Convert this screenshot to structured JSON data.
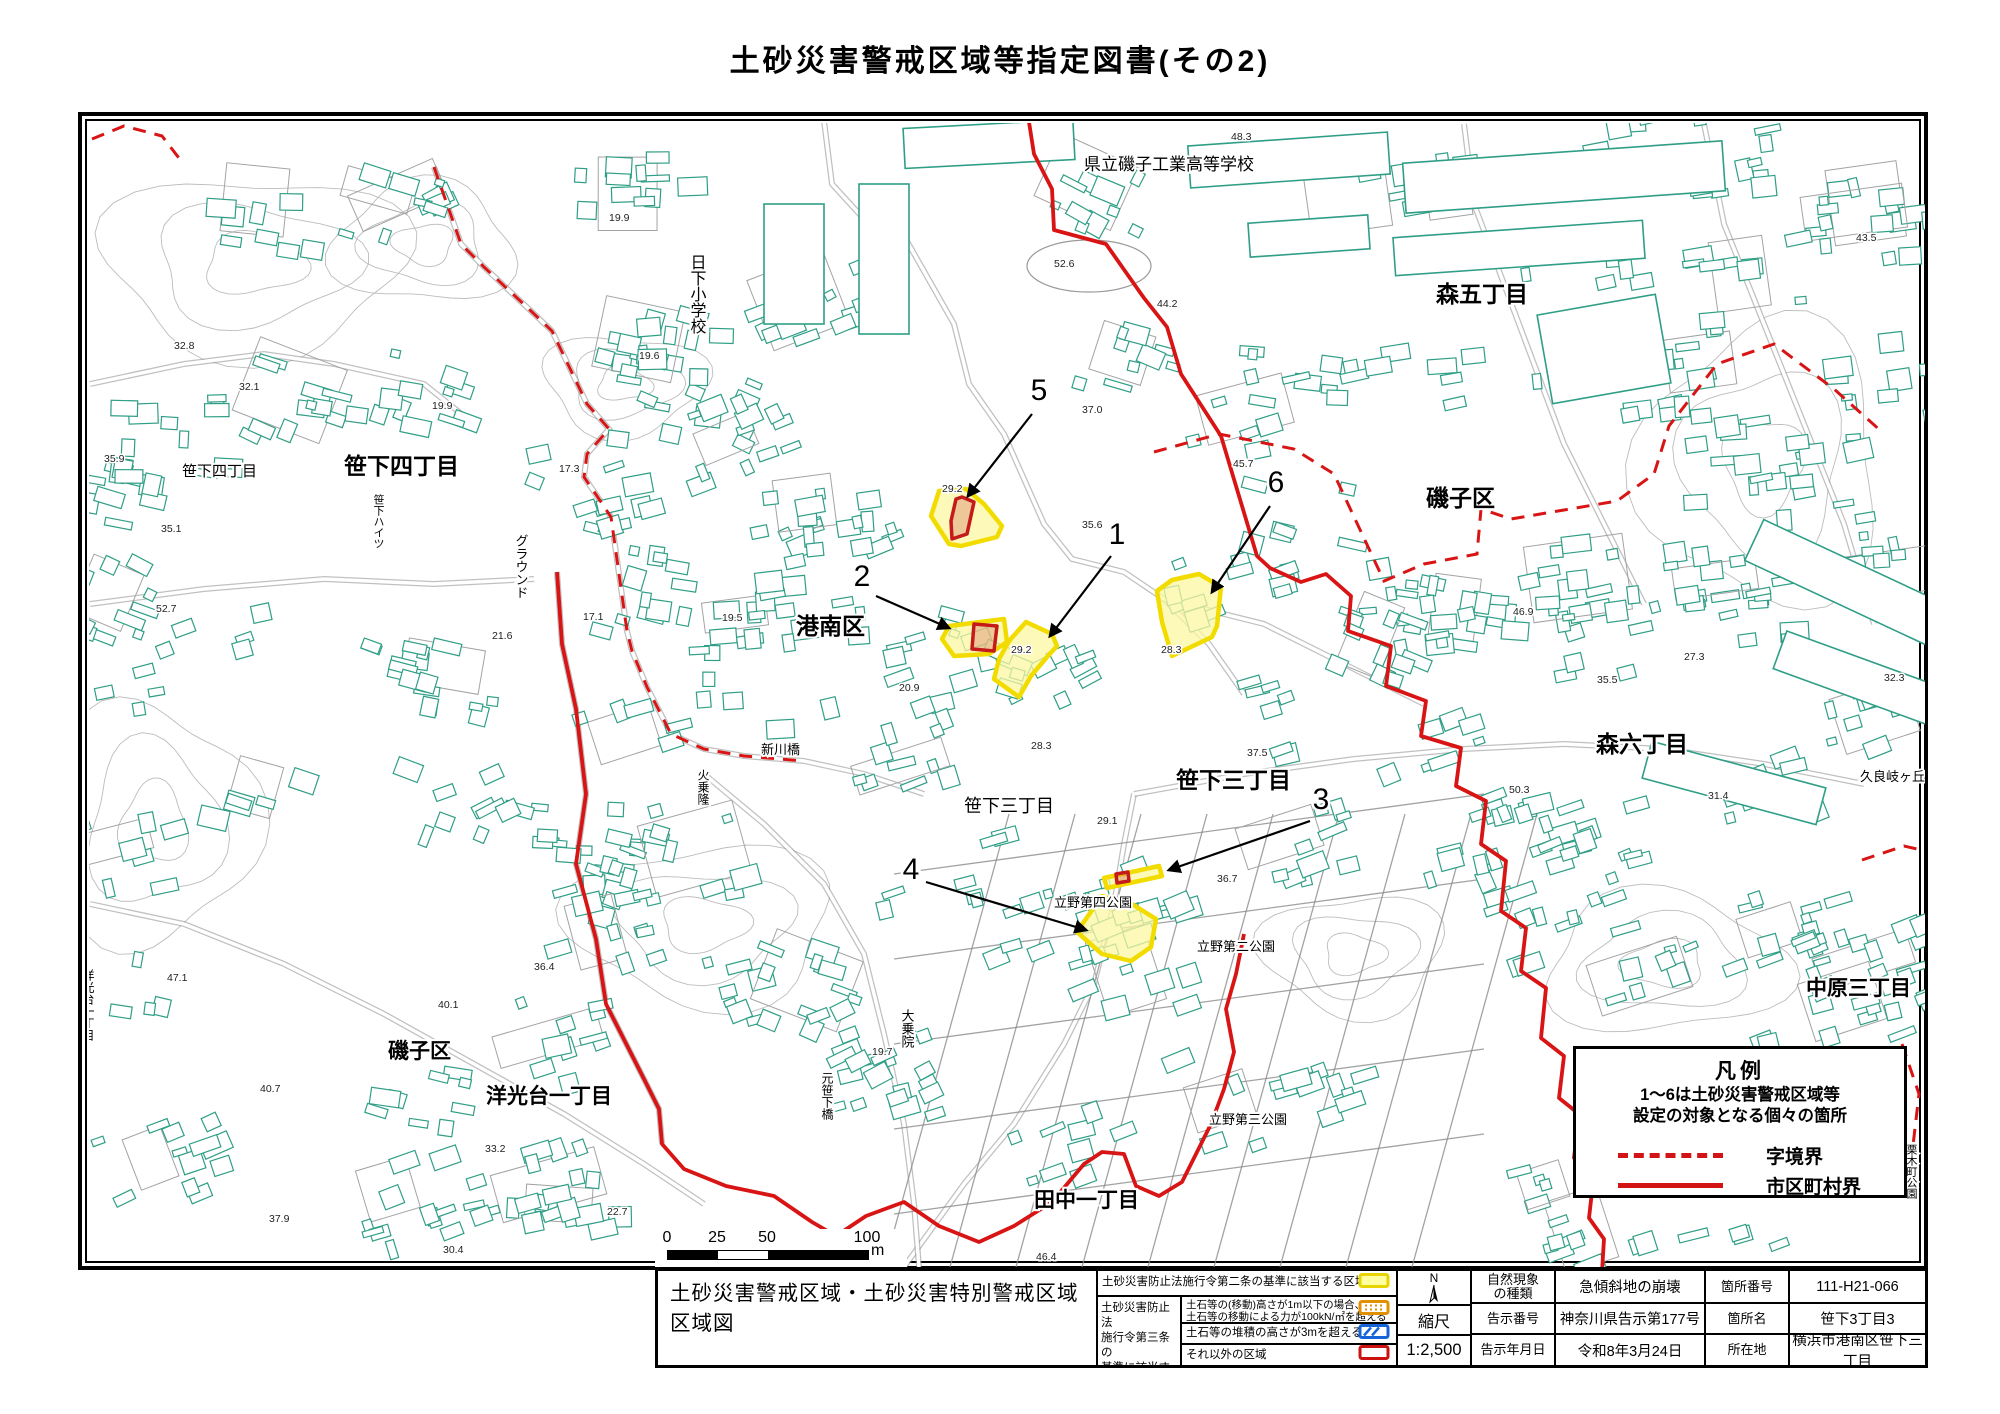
{
  "title": "土砂災害警戒区域等指定図書(その2)",
  "map": {
    "labels": [
      {
        "t": "県立磯子工業高等学校",
        "x": 1080,
        "y": 166,
        "s": 17,
        "v": false,
        "b": false
      },
      {
        "t": "森五丁目",
        "x": 1432,
        "y": 298,
        "s": 23,
        "v": false,
        "b": true
      },
      {
        "t": "日下小学校",
        "x": 692,
        "y": 250,
        "s": 16,
        "v": true,
        "b": false
      },
      {
        "t": "笹下四丁目",
        "x": 178,
        "y": 472,
        "s": 15,
        "v": false,
        "b": false
      },
      {
        "t": "笹下四丁目",
        "x": 340,
        "y": 470,
        "s": 23,
        "v": false,
        "b": true
      },
      {
        "t": "笹下ハイツ",
        "x": 374,
        "y": 490,
        "s": 11,
        "v": true,
        "b": false
      },
      {
        "t": "グラウンド",
        "x": 517,
        "y": 530,
        "s": 13,
        "v": true,
        "b": false
      },
      {
        "t": "磯子区",
        "x": 1422,
        "y": 502,
        "s": 23,
        "v": false,
        "b": true
      },
      {
        "t": "港南区",
        "x": 792,
        "y": 630,
        "s": 23,
        "v": false,
        "b": true
      },
      {
        "t": "新川橋",
        "x": 757,
        "y": 750,
        "s": 13,
        "v": false,
        "b": false
      },
      {
        "t": "笹下三丁目",
        "x": 960,
        "y": 808,
        "s": 18,
        "v": false,
        "b": false
      },
      {
        "t": "笹下三丁目",
        "x": 1172,
        "y": 784,
        "s": 23,
        "v": false,
        "b": true
      },
      {
        "t": "森六丁目",
        "x": 1592,
        "y": 748,
        "s": 23,
        "v": false,
        "b": true
      },
      {
        "t": "久良岐ヶ丘住宅",
        "x": 1856,
        "y": 777,
        "s": 13,
        "v": false,
        "b": false
      },
      {
        "t": "立野第四公園",
        "x": 1050,
        "y": 903,
        "s": 13,
        "v": false,
        "b": false
      },
      {
        "t": "立野第二公園",
        "x": 1193,
        "y": 947,
        "s": 13,
        "v": false,
        "b": false
      },
      {
        "t": "立野第三公園",
        "x": 1205,
        "y": 1120,
        "s": 13,
        "v": false,
        "b": false
      },
      {
        "t": "中原三丁目",
        "x": 1802,
        "y": 991,
        "s": 21,
        "v": false,
        "b": true
      },
      {
        "t": "洋光台一丁目",
        "x": 84,
        "y": 965,
        "s": 12,
        "v": true,
        "b": false
      },
      {
        "t": "磯子区",
        "x": 384,
        "y": 1054,
        "s": 21,
        "v": false,
        "b": true
      },
      {
        "t": "洋光台一丁目",
        "x": 482,
        "y": 1099,
        "s": 21,
        "v": false,
        "b": true
      },
      {
        "t": "田中一丁目",
        "x": 1030,
        "y": 1203,
        "s": 21,
        "v": false,
        "b": true
      },
      {
        "t": "栗木町公園",
        "x": 1907,
        "y": 1140,
        "s": 11,
        "v": true,
        "b": false
      },
      {
        "t": "大乗院",
        "x": 903,
        "y": 1005,
        "s": 13,
        "v": true,
        "b": false
      },
      {
        "t": "元笹下橋",
        "x": 823,
        "y": 1068,
        "s": 12,
        "v": true,
        "b": false
      },
      {
        "t": "火乗隆",
        "x": 699,
        "y": 765,
        "s": 12,
        "v": true,
        "b": false
      }
    ],
    "elevations": [
      {
        "v": "32.8",
        "x": 170,
        "y": 345
      },
      {
        "v": "32.1",
        "x": 235,
        "y": 386
      },
      {
        "v": "35.9",
        "x": 100,
        "y": 458
      },
      {
        "v": "19.9",
        "x": 428,
        "y": 405
      },
      {
        "v": "35.1",
        "x": 157,
        "y": 528
      },
      {
        "v": "19.9",
        "x": 605,
        "y": 217
      },
      {
        "v": "19.6",
        "x": 635,
        "y": 355
      },
      {
        "v": "17.3",
        "x": 555,
        "y": 468
      },
      {
        "v": "17.1",
        "x": 579,
        "y": 616
      },
      {
        "v": "19.5",
        "x": 718,
        "y": 617
      },
      {
        "v": "52.6",
        "x": 1050,
        "y": 263
      },
      {
        "v": "48.3",
        "x": 1227,
        "y": 136
      },
      {
        "v": "44.2",
        "x": 1153,
        "y": 303
      },
      {
        "v": "37.0",
        "x": 1078,
        "y": 409
      },
      {
        "v": "29.2",
        "x": 938,
        "y": 488
      },
      {
        "v": "45.7",
        "x": 1229,
        "y": 463
      },
      {
        "v": "20.9",
        "x": 895,
        "y": 687
      },
      {
        "v": "29.2",
        "x": 1007,
        "y": 649
      },
      {
        "v": "28.3",
        "x": 1157,
        "y": 649
      },
      {
        "v": "28.3",
        "x": 1027,
        "y": 745
      },
      {
        "v": "37.5",
        "x": 1243,
        "y": 752
      },
      {
        "v": "29.1",
        "x": 1093,
        "y": 820
      },
      {
        "v": "36.7",
        "x": 1213,
        "y": 878
      },
      {
        "v": "47.1",
        "x": 163,
        "y": 977
      },
      {
        "v": "40.7",
        "x": 256,
        "y": 1088
      },
      {
        "v": "40.1",
        "x": 434,
        "y": 1004
      },
      {
        "v": "36.4",
        "x": 530,
        "y": 966
      },
      {
        "v": "33.2",
        "x": 481,
        "y": 1148
      },
      {
        "v": "37.9",
        "x": 265,
        "y": 1218
      },
      {
        "v": "30.4",
        "x": 439,
        "y": 1249
      },
      {
        "v": "22.7",
        "x": 603,
        "y": 1211
      },
      {
        "v": "46.9",
        "x": 1509,
        "y": 611
      },
      {
        "v": "35.5",
        "x": 1593,
        "y": 679
      },
      {
        "v": "27.3",
        "x": 1680,
        "y": 656
      },
      {
        "v": "50.3",
        "x": 1505,
        "y": 789
      },
      {
        "v": "31.4",
        "x": 1704,
        "y": 795
      },
      {
        "v": "32.3",
        "x": 1880,
        "y": 677
      },
      {
        "v": "52.7",
        "x": 152,
        "y": 608
      },
      {
        "v": "21.6",
        "x": 488,
        "y": 635
      },
      {
        "v": "19.7",
        "x": 868,
        "y": 1051
      },
      {
        "v": "46.4",
        "x": 1032,
        "y": 1256
      },
      {
        "v": "43.5",
        "x": 1852,
        "y": 237
      },
      {
        "v": "35.6",
        "x": 1078,
        "y": 524
      }
    ],
    "sites": [
      {
        "num": "1",
        "lx": 1113,
        "ly": 540,
        "arrow": [
          1107,
          552,
          1046,
          632
        ],
        "poly": [
          [
            1022,
            618
          ],
          [
            1048,
            630
          ],
          [
            1053,
            642
          ],
          [
            1043,
            653
          ],
          [
            1027,
            672
          ],
          [
            1015,
            693
          ],
          [
            990,
            675
          ],
          [
            995,
            655
          ],
          [
            1005,
            637
          ]
        ]
      },
      {
        "num": "2",
        "lx": 858,
        "ly": 582,
        "arrow": [
          872,
          592,
          945,
          624
        ],
        "poly": [
          [
            945,
            622
          ],
          [
            1000,
            615
          ],
          [
            1003,
            638
          ],
          [
            985,
            650
          ],
          [
            950,
            652
          ],
          [
            938,
            635
          ]
        ],
        "red": [
          [
            970,
            620
          ],
          [
            993,
            622
          ],
          [
            990,
            647
          ],
          [
            968,
            645
          ]
        ]
      },
      {
        "num": "3",
        "lx": 1317,
        "ly": 805,
        "arrow": [
          1306,
          817,
          1165,
          866
        ],
        "poly": [
          [
            1100,
            874
          ],
          [
            1155,
            862
          ],
          [
            1158,
            872
          ],
          [
            1103,
            884
          ]
        ],
        "red": [
          [
            1112,
            870
          ],
          [
            1124,
            868
          ],
          [
            1125,
            877
          ],
          [
            1113,
            879
          ]
        ]
      },
      {
        "num": "4",
        "lx": 907,
        "ly": 875,
        "arrow": [
          922,
          878,
          1082,
          926
        ],
        "poly": [
          [
            1098,
            892
          ],
          [
            1128,
            900
          ],
          [
            1152,
            915
          ],
          [
            1147,
            943
          ],
          [
            1127,
            957
          ],
          [
            1098,
            950
          ],
          [
            1073,
            928
          ],
          [
            1077,
            922
          ]
        ]
      },
      {
        "num": "5",
        "lx": 1035,
        "ly": 396,
        "arrow": [
          1028,
          410,
          964,
          492
        ],
        "poly": [
          [
            935,
            487
          ],
          [
            962,
            485
          ],
          [
            980,
            500
          ],
          [
            998,
            522
          ],
          [
            993,
            533
          ],
          [
            957,
            542
          ],
          [
            945,
            540
          ],
          [
            927,
            512
          ]
        ],
        "red": [
          [
            958,
            493
          ],
          [
            970,
            498
          ],
          [
            963,
            530
          ],
          [
            948,
            535
          ],
          [
            947,
            517
          ],
          [
            952,
            495
          ]
        ]
      },
      {
        "num": "6",
        "lx": 1272,
        "ly": 488,
        "arrow": [
          1266,
          502,
          1208,
          588
        ],
        "poly": [
          [
            1168,
            576
          ],
          [
            1195,
            570
          ],
          [
            1217,
            583
          ],
          [
            1213,
            622
          ],
          [
            1208,
            633
          ],
          [
            1168,
            652
          ],
          [
            1158,
            618
          ],
          [
            1153,
            587
          ]
        ]
      }
    ],
    "boundaries": {
      "solid": [
        [
          [
            1025,
            118
          ],
          [
            1030,
            150
          ],
          [
            1048,
            185
          ],
          [
            1050,
            226
          ],
          [
            1102,
            240
          ],
          [
            1140,
            294
          ],
          [
            1163,
            323
          ],
          [
            1177,
            370
          ],
          [
            1217,
            432
          ],
          [
            1253,
            552
          ],
          [
            1266,
            564
          ],
          [
            1297,
            578
          ],
          [
            1322,
            570
          ],
          [
            1347,
            592
          ],
          [
            1344,
            627
          ],
          [
            1387,
            642
          ],
          [
            1382,
            682
          ],
          [
            1422,
            697
          ],
          [
            1417,
            732
          ],
          [
            1457,
            744
          ],
          [
            1452,
            782
          ],
          [
            1482,
            797
          ],
          [
            1477,
            840
          ],
          [
            1502,
            857
          ],
          [
            1497,
            907
          ],
          [
            1522,
            924
          ],
          [
            1517,
            967
          ],
          [
            1542,
            984
          ],
          [
            1537,
            1034
          ],
          [
            1560,
            1052
          ],
          [
            1555,
            1094
          ],
          [
            1575,
            1110
          ],
          [
            1570,
            1154
          ],
          [
            1590,
            1170
          ],
          [
            1585,
            1214
          ],
          [
            1600,
            1235
          ],
          [
            1598,
            1268
          ]
        ],
        [
          [
            553,
            568
          ],
          [
            558,
            640
          ],
          [
            572,
            705
          ],
          [
            582,
            790
          ],
          [
            572,
            860
          ],
          [
            592,
            935
          ],
          [
            602,
            1000
          ],
          [
            640,
            1075
          ],
          [
            655,
            1105
          ],
          [
            658,
            1140
          ],
          [
            680,
            1165
          ],
          [
            722,
            1182
          ],
          [
            770,
            1192
          ],
          [
            808,
            1218
          ],
          [
            832,
            1232
          ],
          [
            862,
            1212
          ],
          [
            900,
            1198
          ],
          [
            935,
            1222
          ],
          [
            975,
            1238
          ],
          [
            1010,
            1222
          ],
          [
            1048,
            1198
          ],
          [
            1080,
            1160
          ],
          [
            1098,
            1148
          ],
          [
            1120,
            1150
          ],
          [
            1132,
            1182
          ],
          [
            1155,
            1192
          ],
          [
            1178,
            1178
          ],
          [
            1192,
            1150
          ],
          [
            1207,
            1120
          ],
          [
            1220,
            1085
          ],
          [
            1230,
            1048
          ],
          [
            1222,
            1005
          ],
          [
            1232,
            970
          ],
          [
            1240,
            930
          ]
        ]
      ],
      "dashed": [
        [
          [
            88,
            135
          ],
          [
            120,
            122
          ],
          [
            158,
            132
          ],
          [
            178,
            158
          ]
        ],
        [
          [
            430,
            163
          ],
          [
            457,
            240
          ],
          [
            480,
            263
          ],
          [
            527,
            307
          ],
          [
            548,
            327
          ],
          [
            583,
            400
          ],
          [
            605,
            425
          ],
          [
            583,
            450
          ],
          [
            580,
            473
          ],
          [
            593,
            492
          ],
          [
            607,
            513
          ],
          [
            623,
            627
          ],
          [
            628,
            647
          ],
          [
            643,
            683
          ],
          [
            667,
            730
          ],
          [
            700,
            745
          ],
          [
            740,
            752
          ],
          [
            800,
            757
          ]
        ],
        [
          [
            1150,
            448
          ],
          [
            1215,
            430
          ],
          [
            1290,
            445
          ],
          [
            1330,
            470
          ],
          [
            1380,
            577
          ],
          [
            1420,
            560
          ],
          [
            1473,
            550
          ],
          [
            1477,
            505
          ],
          [
            1507,
            515
          ],
          [
            1613,
            497
          ],
          [
            1650,
            470
          ],
          [
            1665,
            422
          ],
          [
            1713,
            360
          ],
          [
            1770,
            340
          ],
          [
            1830,
            385
          ],
          [
            1878,
            428
          ]
        ],
        [
          [
            1858,
            856
          ],
          [
            1900,
            842
          ],
          [
            1926,
            848
          ]
        ],
        [
          [
            1898,
            1040
          ],
          [
            1915,
            1090
          ],
          [
            1908,
            1150
          ]
        ]
      ]
    },
    "colors": {
      "boundary": "#d81414",
      "building": "#2f9e86",
      "site_border": "#f2dc00",
      "site_fill": "#fcf7a0",
      "site_red": "#c41a1a",
      "road": "#8c8c8c",
      "contour": "#bcbcbc"
    }
  },
  "map_legend": {
    "title": "凡例",
    "line1": "1〜6は土砂災害警戒区域等",
    "line2": "設定の対象となる個々の箇所",
    "dashed_label": "字境界",
    "solid_label": "市区町村界"
  },
  "scalebar": {
    "ticks": [
      "0",
      "25",
      "50",
      "100"
    ],
    "unit": "m"
  },
  "footer": {
    "area_map_title_line1": "土砂災害警戒区域・土砂災害特別警戒区域",
    "area_map_title_line2": "区域図",
    "legend2_label": "土砂災害防止法施行令第二条の基準に該当する区域",
    "legend3_group_lines": [
      "土砂災害防止法",
      "施行令第三条の",
      "基準に該当する",
      "区域"
    ],
    "legend3_rows": [
      {
        "line1": "土石等の(移動)高さが1m以下の場合、",
        "line2": "土石等の移動による力が100kN/㎡を超える区域"
      },
      {
        "line1": "土石等の堆積の高さが3mを超える区域",
        "line2": ""
      },
      {
        "line1": "それ以外の区域",
        "line2": ""
      }
    ],
    "compass_label": "N",
    "scale_label": "縮尺",
    "scale_value": "1:2,500",
    "info_rows": [
      {
        "k1a": "自然現象",
        "k1b": "の種類",
        "v1": "急傾斜地の崩壊",
        "k2": "箇所番号",
        "v2": "111-H21-066"
      },
      {
        "k1a": "告示番号",
        "k1b": "",
        "v1": "神奈川県告示第177号",
        "k2": "箇所名",
        "v2": "笹下3丁目3"
      },
      {
        "k1a": "告示年月日",
        "k1b": "",
        "v1": "令和8年3月24日",
        "k2": "所在地",
        "v2": "横浜市港南区笹下三丁目"
      }
    ]
  }
}
